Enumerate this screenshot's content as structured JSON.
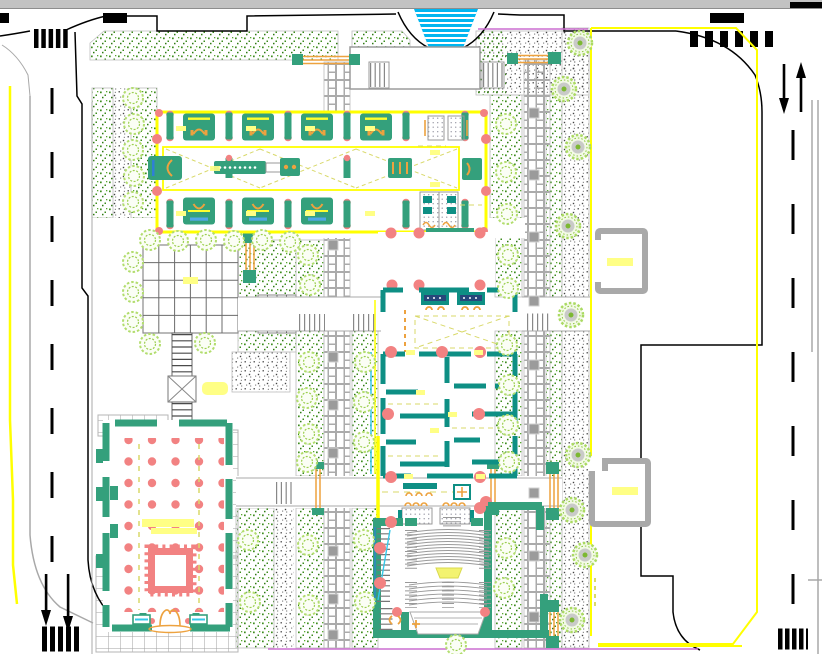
{
  "document": {
    "kind": "Architectural campus site plan (CAD drawing)",
    "visible_text": "none",
    "canvas_background": "#ffffff"
  },
  "colors": {
    "band": "#c2c2c2",
    "ink": "#000000",
    "curb": "#a8a8a8",
    "grid": "#6b6b6b",
    "yellow": "#ffff00",
    "paleyellow": "#ffff85",
    "khaki": "#d9d96a",
    "wall": "#34a07c",
    "wall2": "#0e8f84",
    "salmon": "#f28282",
    "orange": "#eda23f",
    "blue": "#2f7fd6",
    "cyan": "#35c8e8",
    "water": "#00b6f0",
    "leaf": "#3d8c1e",
    "magenta": "#cc6fd0",
    "navy": "#27477a"
  },
  "legend": {
    "roads": [
      "left vertical street with dashed centerline",
      "right vertical street with dashed centerline"
    ],
    "road_markings": [
      "zebra crosswalks at four corners",
      "lane direction arrows",
      "yellow edge lines"
    ],
    "water_feature": "cascading fountain at top center (cyan stripes)",
    "planting": [
      "stippled green planting beds",
      "gravel stipple strips",
      "row trees with gray canopies",
      "outline shrubs"
    ],
    "paths": [
      "basketweave paver walks with square lamps",
      "stepped pedestrian corridors",
      "gridded plazas",
      "ladder stair path"
    ],
    "buildings": [
      "north classroom wing outlined in yellow with columned bays and furniture",
      "central block with teal room partitions and entrance lobby",
      "fan-shaped auditorium with curved seating rows and stage",
      "southwest hall with red column grid and arched entrance"
    ],
    "site_objects": [
      "pergola benches with orange slats",
      "two gray shelter kiosks with yellow label bars",
      "yellow benches",
      "red column dots",
      "magenta property line"
    ]
  }
}
